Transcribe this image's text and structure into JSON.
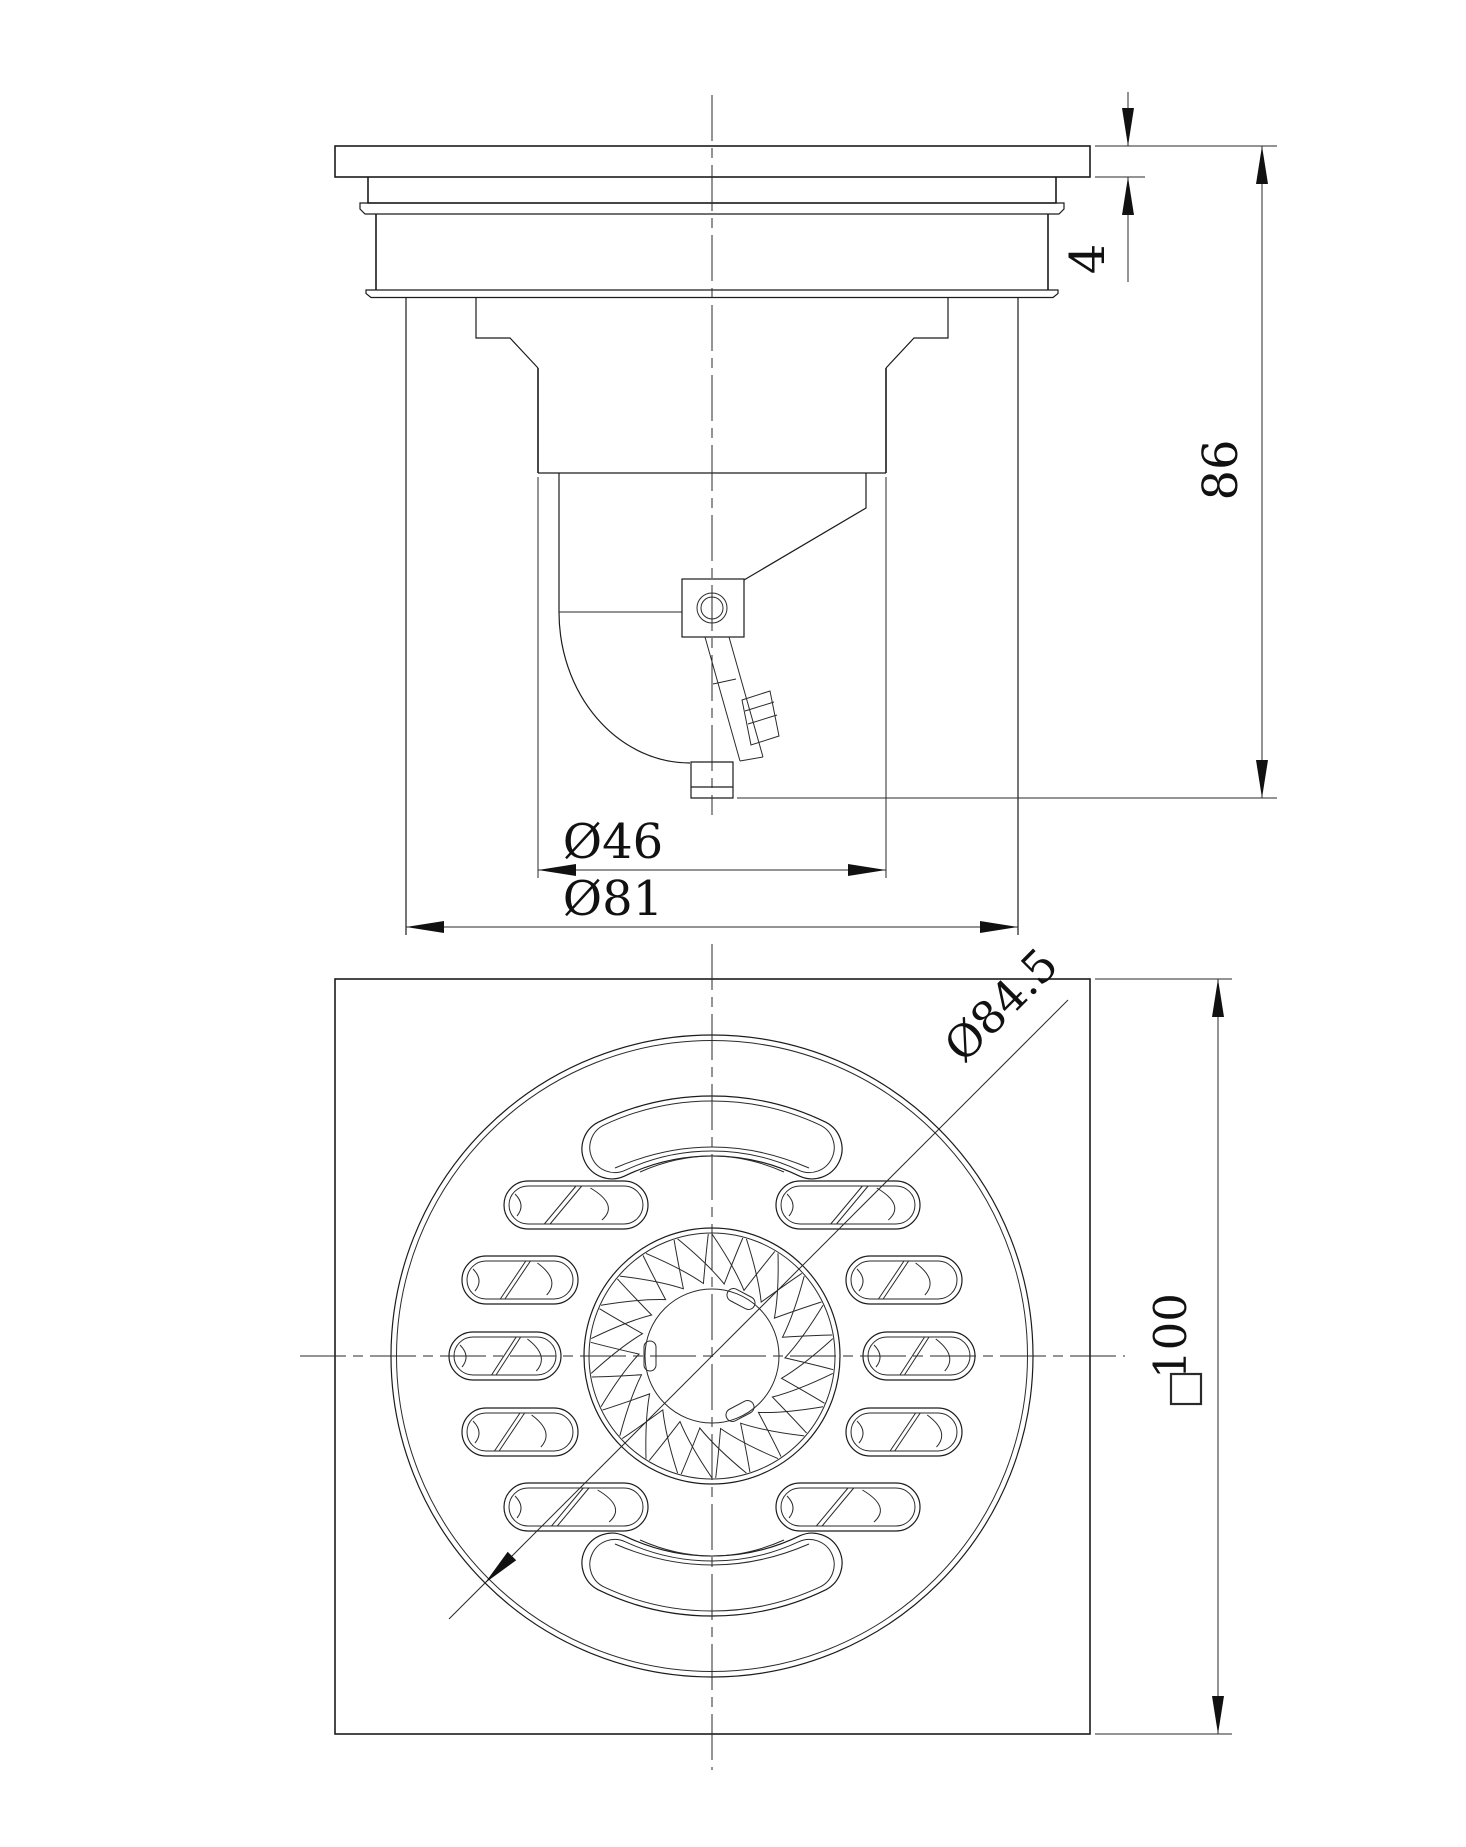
{
  "drawing": {
    "type": "engineering-drawing",
    "subject": "floor-drain two-view dimensioned drawing",
    "colors": {
      "background": "#ffffff",
      "line": "#1c1c1c",
      "text": "#111111"
    },
    "views": {
      "section": {
        "label": "section-elevation-view"
      },
      "plan": {
        "label": "plan-grate-view"
      }
    },
    "dims": {
      "flange_thickness": "4",
      "overall_height": "86",
      "outlet_diameter": "Ø46",
      "body_diameter": "Ø81",
      "grate_diameter": "Ø84.5",
      "plate_size": "100",
      "plate_size_symbol": "□",
      "plate_size_full": "□100"
    }
  }
}
